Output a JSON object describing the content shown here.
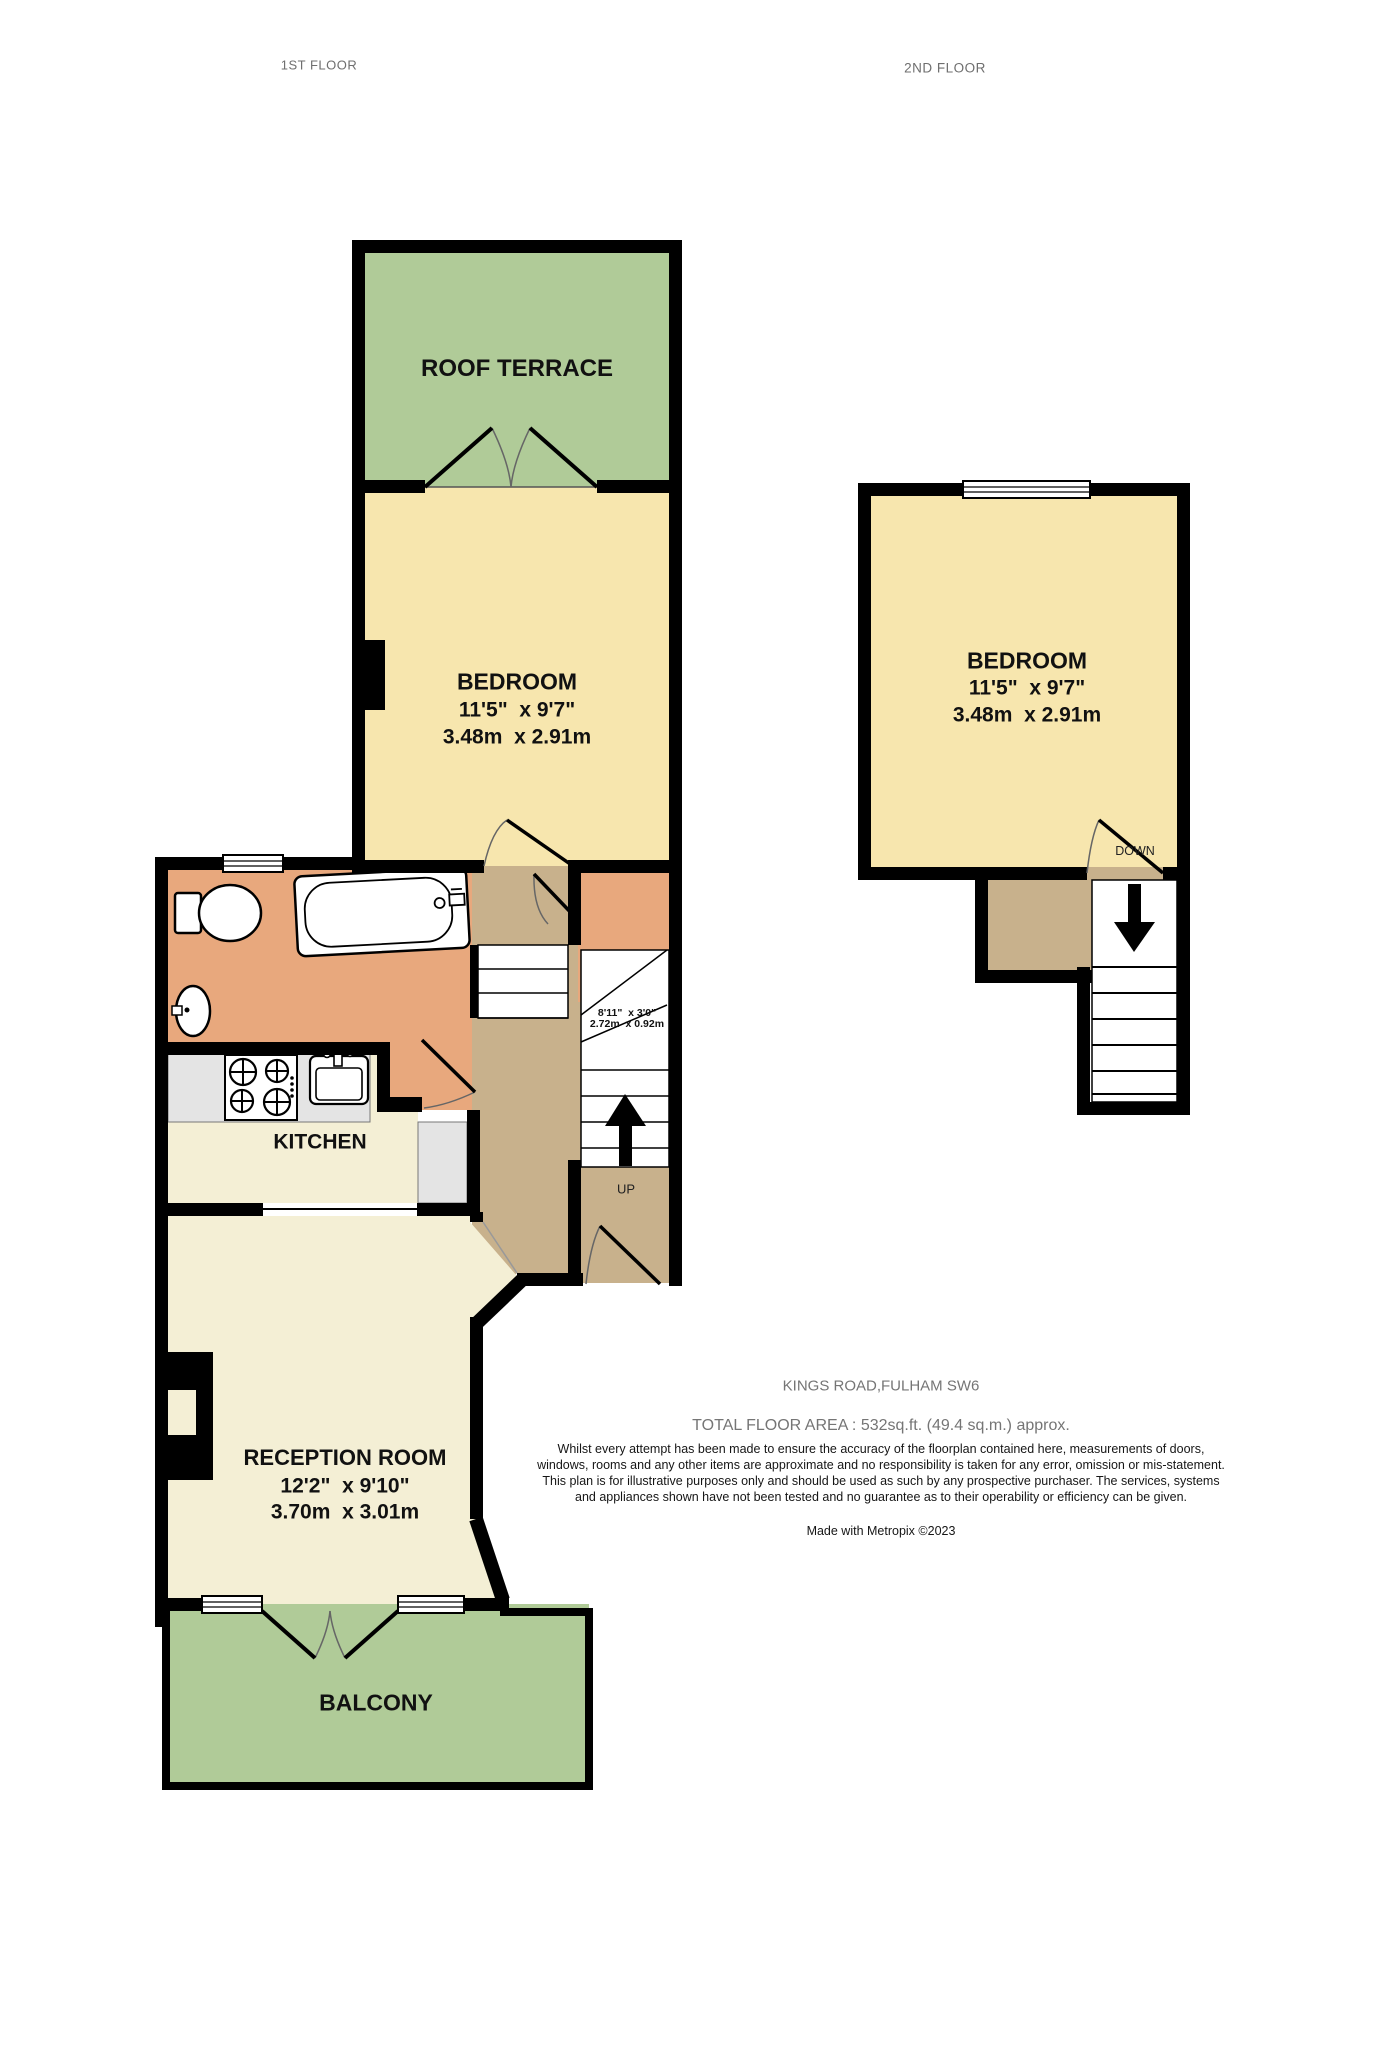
{
  "floors": {
    "first_label": "1ST FLOOR",
    "second_label": "2ND FLOOR"
  },
  "rooms": {
    "roof_terrace": {
      "name": "ROOF TERRACE"
    },
    "bedroom_first": {
      "name": "BEDROOM",
      "dims_imperial": "11'5\"  x 9'7\"",
      "dims_metric": "3.48m  x 2.91m"
    },
    "bedroom_second": {
      "name": "BEDROOM",
      "dims_imperial": "11'5\"  x 9'7\"",
      "dims_metric": "3.48m  x 2.91m"
    },
    "kitchen": {
      "name": "KITCHEN"
    },
    "reception": {
      "name": "RECEPTION ROOM",
      "dims_imperial": "12'2\"  x 9'10\"",
      "dims_metric": "3.70m  x 3.01m"
    },
    "balcony": {
      "name": "BALCONY"
    },
    "stairs": {
      "dims_imperial": "8'11\"  x 3'0\"",
      "dims_metric": "2.72m  x 0.92m",
      "up_label": "UP",
      "down_label": "DOWN"
    }
  },
  "footer": {
    "address": "KINGS ROAD,FULHAM SW6",
    "total_area": "TOTAL FLOOR AREA : 532sq.ft. (49.4 sq.m.) approx.",
    "disclaimer": "Whilst every attempt has been made to ensure the accuracy of the floorplan contained here, measurements of doors, windows, rooms and any other items are approximate and no responsibility is taken for any error, omission or mis-statement. This plan is for illustrative purposes only and should be used as such by any prospective purchaser. The services, systems and appliances shown have not been tested and no guarantee as to their operability or efficiency can be given.",
    "credit": "Made with Metropix ©2023"
  },
  "colors": {
    "terrace_balcony_green": "#b0cb98",
    "bedroom_yellow": "#f7e6ae",
    "bathroom_orange": "#e8a87d",
    "hall_tan": "#c8b18c",
    "kitchen_reception_cream": "#f4efd5",
    "counter_gray": "#e4e4e4",
    "wall_black": "#000000",
    "footer_gray": "#757575"
  }
}
